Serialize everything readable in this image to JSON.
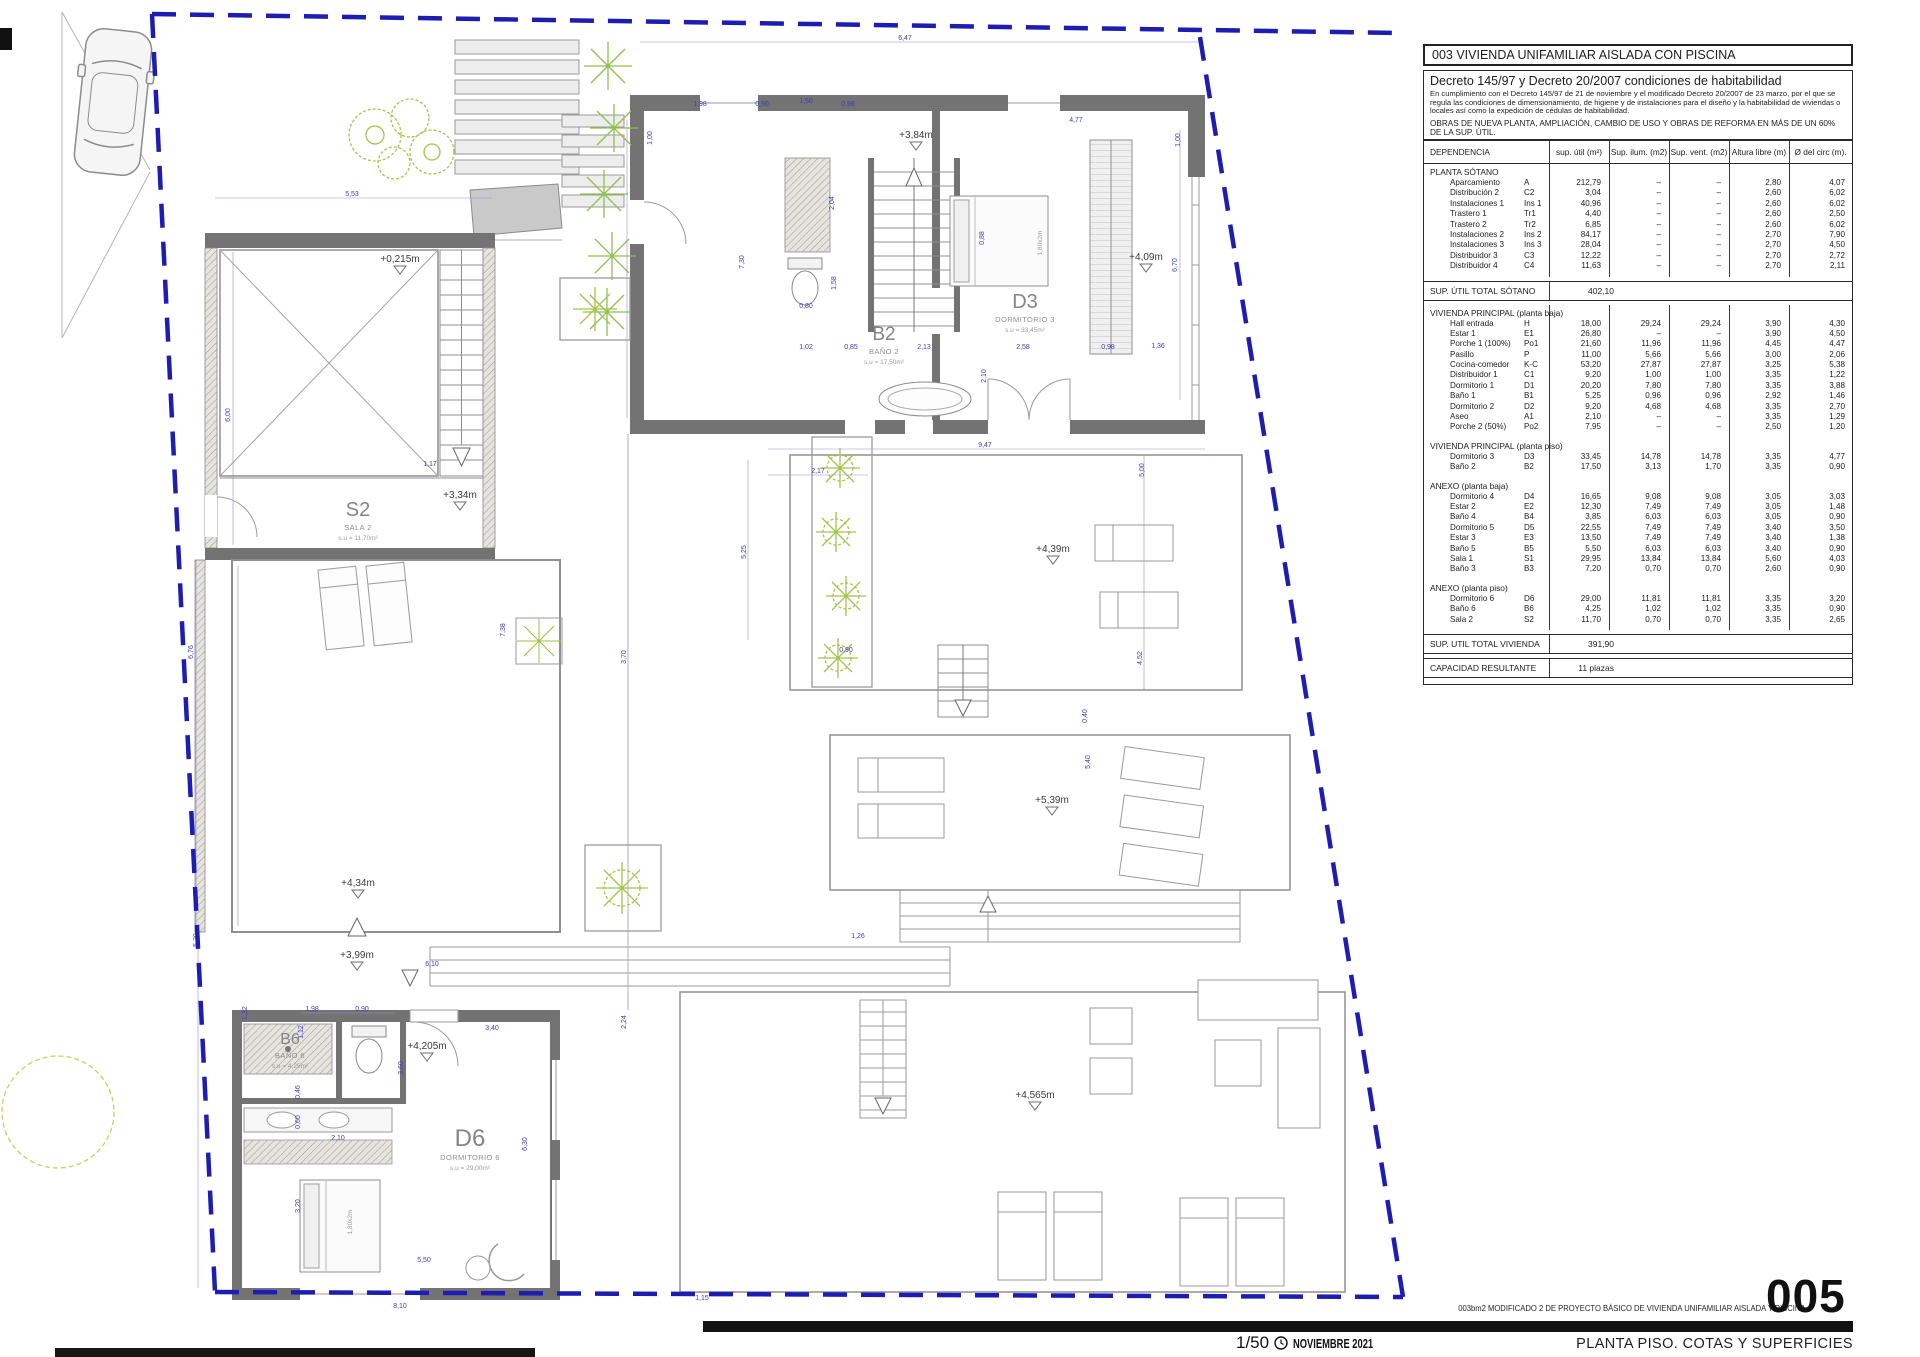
{
  "panel": {
    "title": "003 VIVIENDA UNIFAMILIAR AISLADA CON PISCINA",
    "decreto": {
      "heading": "Decreto 145/97 y Decreto 20/2007 condiciones de habitabilidad",
      "body": "En cumplimiento con el Decreto 145/97 de 21 de noviembre y el modificado Decreto 20/2007 de 23 marzo, por el que se regula las condiciones de dimensionamiento, de higiene y de instalaciones para el diseño y la habitabilidad de viviendas o locales así como la expedición de cédulas de habitabilidad.",
      "obras": "OBRAS DE NUEVA PLANTA, AMPLIACIÓN, CAMBIO DE USO Y OBRAS DE REFORMA EN MÁS DE UN 60% DE LA SUP. ÚTIL."
    },
    "table": {
      "columns": [
        "DEPENDENCIA",
        "sup. útil (m²)",
        "Sup. ilum. (m2)",
        "Sup. vent. (m2)",
        "Altura libre (m)",
        "Ø del circ (m)."
      ],
      "blocks": [
        {
          "type": "section",
          "name": "PLANTA SÓTANO"
        },
        {
          "type": "rows",
          "rows": [
            [
              "Aparcamiento",
              "A",
              "212,79",
              "–",
              "–",
              "2,80",
              "4,07"
            ],
            [
              "Distribución 2",
              "C2",
              "3,04",
              "–",
              "–",
              "2,60",
              "6,02"
            ],
            [
              "Instalaciones 1",
              "Ins 1",
              "40,96",
              "–",
              "–",
              "2,60",
              "6,02"
            ],
            [
              "Trastero 1",
              "Tr1",
              "4,40",
              "–",
              "–",
              "2,60",
              "2,50"
            ],
            [
              "Trastero 2",
              "Tr2",
              "6,85",
              "–",
              "–",
              "2,60",
              "6,02"
            ],
            [
              "Instalaciones 2",
              "Ins 2",
              "84,17",
              "–",
              "–",
              "2,70",
              "7,90"
            ],
            [
              "Instalaciones 3",
              "Ins 3",
              "28,04",
              "–",
              "–",
              "2,70",
              "4,50"
            ],
            [
              "Distribuidor 3",
              "C3",
              "12,22",
              "–",
              "–",
              "2,70",
              "2,72"
            ],
            [
              "Distribuidor 4",
              "C4",
              "11,63",
              "–",
              "–",
              "2,70",
              "2,11"
            ]
          ]
        },
        {
          "type": "total",
          "label": "SUP. ÚTIL TOTAL SÓTANO",
          "value": "402,10"
        },
        {
          "type": "section",
          "name": "VIVIENDA PRINCIPAL (planta baja)"
        },
        {
          "type": "rows",
          "rows": [
            [
              "Hall entrada",
              "H",
              "18,00",
              "29,24",
              "29,24",
              "3,90",
              "4,30"
            ],
            [
              "Estar 1",
              "E1",
              "26,80",
              "–",
              "–",
              "3,90",
              "4,50"
            ],
            [
              "Porche 1 (100%)",
              "Po1",
              "21,60",
              "11,96",
              "11,96",
              "4,45",
              "4,47"
            ],
            [
              "Pasillo",
              "P",
              "11,00",
              "5,66",
              "5,66",
              "3,00",
              "2,06"
            ],
            [
              "Cocina-comedor",
              "K-C",
              "53,20",
              "27,87",
              "27,87",
              "3,25",
              "5,38"
            ],
            [
              "Distribuidor 1",
              "C1",
              "9,20",
              "1,00",
              "1,00",
              "3,35",
              "1,22"
            ],
            [
              "Dormitorio 1",
              "D1",
              "20,20",
              "7,80",
              "7,80",
              "3,35",
              "3,88"
            ],
            [
              "Baño 1",
              "B1",
              "5,25",
              "0,96",
              "0,96",
              "2,92",
              "1,46"
            ],
            [
              "Dormitorio 2",
              "D2",
              "9,20",
              "4,68",
              "4,68",
              "3,35",
              "2,70"
            ],
            [
              "Aseo",
              "A1",
              "2,10",
              "–",
              "–",
              "3,35",
              "1,29"
            ],
            [
              "Porche 2 (50%)",
              "Po2",
              "7,95",
              "–",
              "–",
              "2,50",
              "1,20"
            ]
          ]
        },
        {
          "type": "section",
          "name": "VIVIENDA PRINCIPAL (planta piso)"
        },
        {
          "type": "rows",
          "rows": [
            [
              "Dormitorio 3",
              "D3",
              "33,45",
              "14,78",
              "14,78",
              "3,35",
              "4,77"
            ],
            [
              "Baño 2",
              "B2",
              "17,50",
              "3,13",
              "1,70",
              "3,35",
              "0,90"
            ]
          ]
        },
        {
          "type": "section",
          "name": "ANEXO (planta baja)"
        },
        {
          "type": "rows",
          "rows": [
            [
              "Dormitorio 4",
              "D4",
              "16,65",
              "9,08",
              "9,08",
              "3,05",
              "3,03"
            ],
            [
              "Estar 2",
              "E2",
              "12,30",
              "7,49",
              "7,49",
              "3,05",
              "1,48"
            ],
            [
              "Baño 4",
              "B4",
              "3,85",
              "6,03",
              "6,03",
              "3,05",
              "0,90"
            ],
            [
              "Dormitorio 5",
              "D5",
              "22,55",
              "7,49",
              "7,49",
              "3,40",
              "3,50"
            ],
            [
              "Estar 3",
              "E3",
              "13,50",
              "7,49",
              "7,49",
              "3,40",
              "1,38"
            ],
            [
              "Baño 5",
              "B5",
              "5,50",
              "6,03",
              "6,03",
              "3,40",
              "0,90"
            ],
            [
              "Sala 1",
              "S1",
              "29,95",
              "13,84",
              "13,84",
              "5,60",
              "4,03"
            ],
            [
              "Baño 3",
              "B3",
              "7,20",
              "0,70",
              "0,70",
              "2,60",
              "0,90"
            ]
          ]
        },
        {
          "type": "section",
          "name": "ANEXO (planta piso)"
        },
        {
          "type": "rows",
          "rows": [
            [
              "Dormitorio 6",
              "D6",
              "29,00",
              "11,81",
              "11,81",
              "3,35",
              "3,20"
            ],
            [
              "Baño 6",
              "B6",
              "4,25",
              "1,02",
              "1,02",
              "3,35",
              "0,90"
            ],
            [
              "Sala 2",
              "S2",
              "11,70",
              "0,70",
              "0,70",
              "3,35",
              "2,65"
            ]
          ]
        },
        {
          "type": "total",
          "label": "SUP. UTIL TOTAL VIVIENDA",
          "value": "391,90"
        },
        {
          "type": "total",
          "label": "CAPACIDAD RESULTANTE",
          "value": "11 plazas"
        }
      ]
    }
  },
  "title_block": {
    "project_line": "003bm2   MODIFICADO 2 DE PROYECTO BÁSICO DE VIVIENDA UNIFAMILIAR AISLADA Y PISCINA",
    "sheet_number": "005",
    "sheet_title": "PLANTA PISO. COTAS Y SUPERFICIES",
    "scale": "1/50",
    "date": "NOVIEMBRE 2021"
  },
  "plan": {
    "boundary_color": "#1d1db2",
    "wall_color": "#737373",
    "dim_color": "#3c3cc0",
    "vegetation_color": "#a5c44c",
    "rooms": [
      {
        "code": "S2",
        "name": "SALA 2",
        "area": "s.u = 11,70m²",
        "x": 358,
        "y": 516,
        "size": 20
      },
      {
        "code": "B2",
        "name": "BAÑO 2",
        "area": "s.u = 17,50m²",
        "x": 884,
        "y": 340,
        "size": 19
      },
      {
        "code": "D3",
        "name": "DORMITORIO 3",
        "area": "s.u = 33,45m²",
        "x": 1025,
        "y": 308,
        "size": 20
      },
      {
        "code": "B6",
        "name": "BAÑO 6",
        "area": "s.u = 4,25m²",
        "x": 290,
        "y": 1044,
        "size": 16
      },
      {
        "code": "D6",
        "name": "DORMITORIO 6",
        "area": "s.u = 29,00m²",
        "x": 470,
        "y": 1146,
        "size": 24
      }
    ],
    "levels": [
      {
        "t": "+0,215m",
        "x": 400,
        "y": 262
      },
      {
        "t": "+3,34m",
        "x": 460,
        "y": 498
      },
      {
        "t": "+3,84m",
        "x": 916,
        "y": 138
      },
      {
        "t": "+4,09m",
        "x": 1146,
        "y": 260
      },
      {
        "t": "+4,34m",
        "x": 358,
        "y": 886
      },
      {
        "t": "+3,99m",
        "x": 357,
        "y": 958
      },
      {
        "t": "+4,205m",
        "x": 427,
        "y": 1049
      },
      {
        "t": "+4,39m",
        "x": 1053,
        "y": 552
      },
      {
        "t": "+5,39m",
        "x": 1052,
        "y": 803
      },
      {
        "t": "+4,565m",
        "x": 1035,
        "y": 1098
      }
    ],
    "bed_labels": [
      {
        "t": "1,80x2m",
        "x": 1042,
        "y": 243
      },
      {
        "t": "1,80x2m",
        "x": 352,
        "y": 1222
      }
    ],
    "dims": [
      {
        "t": "6,47",
        "x": 905,
        "y": 40
      },
      {
        "t": "5,53",
        "x": 352,
        "y": 196
      },
      {
        "t": "1,98",
        "x": 700,
        "y": 106
      },
      {
        "t": "0,90",
        "x": 762,
        "y": 106
      },
      {
        "t": "1,50",
        "x": 806,
        "y": 103
      },
      {
        "t": "0,96",
        "x": 848,
        "y": 106
      },
      {
        "t": "4,77",
        "x": 1076,
        "y": 122
      },
      {
        "t": "1,00",
        "x": 652,
        "y": 138,
        "r": 1
      },
      {
        "t": "1,00",
        "x": 1180,
        "y": 140,
        "r": 1
      },
      {
        "t": "7,30",
        "x": 744,
        "y": 262,
        "r": 1
      },
      {
        "t": "2,04",
        "x": 834,
        "y": 203,
        "r": 1
      },
      {
        "t": "1,58",
        "x": 836,
        "y": 283,
        "r": 1
      },
      {
        "t": "0,80",
        "x": 806,
        "y": 308
      },
      {
        "t": "1,02",
        "x": 806,
        "y": 349
      },
      {
        "t": "0,85",
        "x": 851,
        "y": 349
      },
      {
        "t": "2,13",
        "x": 924,
        "y": 349
      },
      {
        "t": "2,58",
        "x": 1023,
        "y": 349
      },
      {
        "t": "0,98",
        "x": 1108,
        "y": 349
      },
      {
        "t": "1,36",
        "x": 1158,
        "y": 348
      },
      {
        "t": "0,88",
        "x": 984,
        "y": 238,
        "r": 1
      },
      {
        "t": "2,10",
        "x": 986,
        "y": 376,
        "r": 1
      },
      {
        "t": "6,70",
        "x": 1177,
        "y": 265,
        "r": 1
      },
      {
        "t": "9,47",
        "x": 985,
        "y": 447
      },
      {
        "t": "2,17",
        "x": 818,
        "y": 473
      },
      {
        "t": "5,25",
        "x": 746,
        "y": 552,
        "r": 1
      },
      {
        "t": "0,90",
        "x": 846,
        "y": 652
      },
      {
        "t": "6,00",
        "x": 230,
        "y": 415,
        "r": 1
      },
      {
        "t": "6,76",
        "x": 193,
        "y": 652,
        "r": 1
      },
      {
        "t": "5,20",
        "x": 198,
        "y": 940,
        "r": 1
      },
      {
        "t": "1,17",
        "x": 430,
        "y": 466
      },
      {
        "t": "7,38",
        "x": 505,
        "y": 630,
        "r": 1
      },
      {
        "t": "3,70",
        "x": 626,
        "y": 657,
        "r": 1
      },
      {
        "t": "2,24",
        "x": 626,
        "y": 1022,
        "r": 1
      },
      {
        "t": "6,10",
        "x": 432,
        "y": 966
      },
      {
        "t": "3,40",
        "x": 492,
        "y": 1030
      },
      {
        "t": "1,32",
        "x": 247,
        "y": 1013,
        "r": 1
      },
      {
        "t": "1,98",
        "x": 312,
        "y": 1011
      },
      {
        "t": "0,90",
        "x": 362,
        "y": 1011
      },
      {
        "t": "1,12",
        "x": 303,
        "y": 1032,
        "r": 1
      },
      {
        "t": "3,60",
        "x": 403,
        "y": 1068,
        "r": 1
      },
      {
        "t": "2,10",
        "x": 338,
        "y": 1140
      },
      {
        "t": "0,46",
        "x": 300,
        "y": 1092,
        "r": 1
      },
      {
        "t": "0,60",
        "x": 300,
        "y": 1122,
        "r": 1
      },
      {
        "t": "3,20",
        "x": 300,
        "y": 1206,
        "r": 1
      },
      {
        "t": "5,50",
        "x": 424,
        "y": 1262
      },
      {
        "t": "6,30",
        "x": 527,
        "y": 1144,
        "r": 1
      },
      {
        "t": "1,26",
        "x": 858,
        "y": 938
      },
      {
        "t": "1,15",
        "x": 702,
        "y": 1300
      },
      {
        "t": "8,10",
        "x": 400,
        "y": 1308
      },
      {
        "t": "5,00",
        "x": 1144,
        "y": 470,
        "r": 1
      },
      {
        "t": "4,52",
        "x": 1142,
        "y": 658,
        "r": 1
      },
      {
        "t": "0,40",
        "x": 1087,
        "y": 716,
        "r": 1
      },
      {
        "t": "5,40",
        "x": 1090,
        "y": 762,
        "r": 1
      }
    ]
  }
}
